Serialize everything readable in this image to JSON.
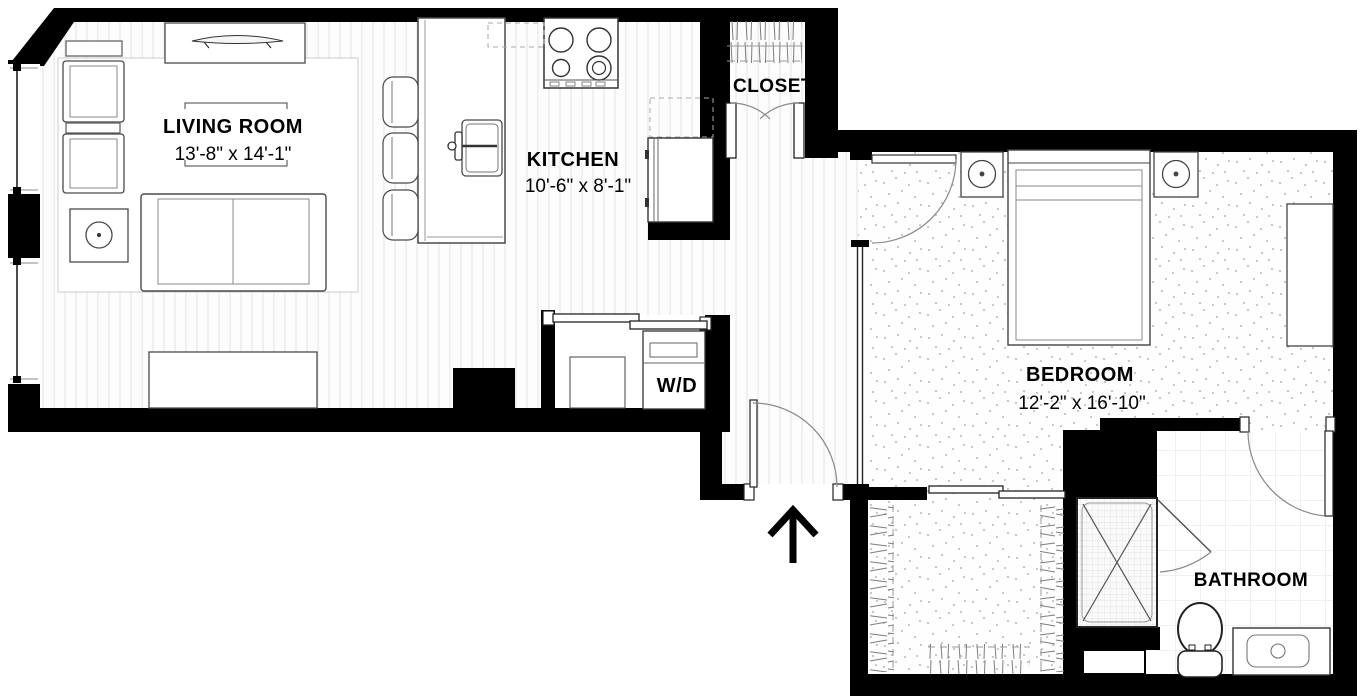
{
  "plan": {
    "type": "apartment-floor-plan",
    "units": "feet-inches"
  },
  "rooms": {
    "living_room": {
      "name": "LIVING ROOM",
      "dimensions": "13'-8\" x 14'-1\""
    },
    "kitchen": {
      "name": "KITCHEN",
      "dimensions": "10'-6\" x 8'-1\""
    },
    "bedroom": {
      "name": "BEDROOM",
      "dimensions": "12'-2\" x 16'-10\""
    },
    "closet": {
      "name": "CLOSET"
    },
    "bathroom": {
      "name": "BATHROOM"
    },
    "laundry": {
      "name": "W/D"
    }
  },
  "fixtures": [
    "tv-console",
    "armchair",
    "armchair",
    "side-table-lamp",
    "sofa",
    "ottoman",
    "rug",
    "kitchen-island-sink",
    "bar-stool",
    "bar-stool",
    "bar-stool",
    "stove",
    "refrigerator",
    "washer-dryer",
    "laundry-basket",
    "hanging-clothes-rod",
    "bed",
    "nightstand",
    "nightstand",
    "dresser",
    "walk-in-closet-rods",
    "shower",
    "toilet",
    "vanity-sink",
    "entry-arrow"
  ],
  "entry": {
    "indicator": "entry-arrow-up"
  },
  "colors": {
    "wall": "#000000",
    "background": "#ffffff",
    "plank_line": "#e3e3e3",
    "carpet_dot": "#9a9a9a",
    "tile_line": "#e2e2e2",
    "furniture_stroke": "#4a4a4a",
    "door_arc": "#8a8a8a",
    "text": "#000000"
  }
}
